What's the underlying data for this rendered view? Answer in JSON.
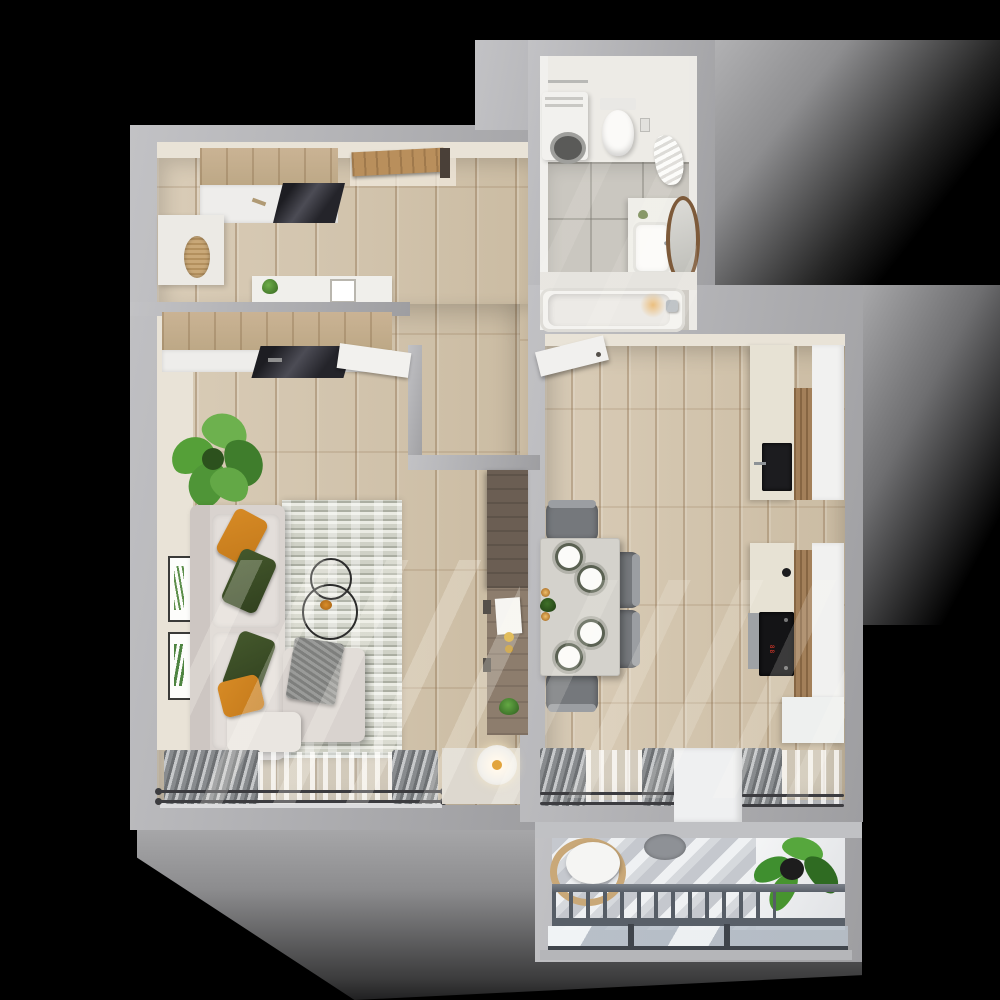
{
  "scene": {
    "name": "3d-apartment-floor-plan-top-view",
    "width": 1000,
    "height": 1000,
    "background": "#000000",
    "cooktop_display": "88"
  },
  "palette": {
    "bg": "#000000",
    "wallGray": "#aeaeb1",
    "wallLight": "#c2c2c5",
    "innerFace": "#e9e3d7",
    "wood": "#d9ccb7",
    "woodDark": "#cbbca3",
    "bathTile": "#cac7c0",
    "bathLight": "#edebe6",
    "cream": "#e7e2d4",
    "cabinetWood": "#bda886",
    "kitchenWoodPanel": "#a3805a",
    "darkWood": "#6b5e53",
    "midWood": "#8d7d6d",
    "sofa": "#d9d3cf",
    "sofaLight": "#e3deda",
    "pillowOrange": "#c47a1b",
    "pillowGreen": "#31411f",
    "blanket": "#919290",
    "chairGray": "#75787c",
    "tableTop": "#d4d2cc",
    "plateRim": "#5a6152",
    "cooktopBlack": "#141416",
    "displayRed": "#e8392a",
    "curtain": "#87898c",
    "rodDark": "#3c3c40",
    "railing": "#596069",
    "glass": "#b7c0ca",
    "plantGreen": "#4e8f33",
    "plantDark": "#2c5a1f",
    "rattan": "#c9a878",
    "amber": "#e2a43c"
  },
  "rooms": {
    "hallway": {
      "label": "entry hall",
      "items": [
        "entry-door",
        "wardrobe-with-mirror",
        "bench-rattan-seat",
        "console-table",
        "small-plant",
        "photo-frame"
      ]
    },
    "bathroom": {
      "label": "bathroom",
      "items": [
        "washing-machine",
        "wall-hung-toilet",
        "hanging-towel",
        "vanity-sink",
        "round-mirror",
        "bathtub"
      ]
    },
    "living_room": {
      "label": "living room",
      "items": [
        "corner-sofa",
        "orange-pillows",
        "green-pillows",
        "throw-blanket",
        "ottoman",
        "area-rug",
        "nesting-coffee-tables",
        "monstera-plant",
        "two-wall-art-frames",
        "wardrobe-with-mirror",
        "desk-shelf-unit",
        "floor-lamp",
        "window-curtains"
      ]
    },
    "kitchen": {
      "label": "kitchen and dining",
      "items": [
        "open-door",
        "dining-table",
        "four-plates",
        "two-candles",
        "centerpiece-plant",
        "five-chairs",
        "sink-counter",
        "cooktop-counter",
        "wood-cabinet-panels",
        "white-cabinets",
        "two-windows-with-curtains",
        "balcony-door-pier"
      ]
    },
    "balcony": {
      "label": "balcony",
      "items": [
        "rattan-chair-with-cushion",
        "round-side-table",
        "potted-plant",
        "striped-deck",
        "railing-balusters",
        "glass-panels"
      ]
    }
  }
}
